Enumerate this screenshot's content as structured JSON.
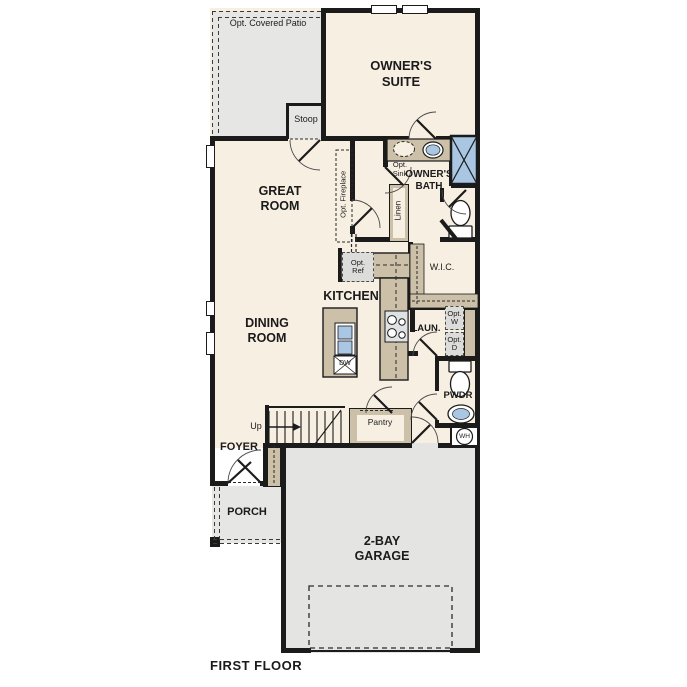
{
  "title": "FIRST FLOOR",
  "colors": {
    "floor_cream": "#f7efe2",
    "exterior_gray": "#e6e6e4",
    "cabinet_tan": "#ccc0a8",
    "water_blue": "#a9c6e3",
    "wall_black": "#1b1b1b",
    "appliance_gray": "#dcdcda"
  },
  "labels": {
    "patio": "Opt. Covered Patio",
    "stoop": "Stoop",
    "owners_suite": "OWNER'S\nSUITE",
    "great_room": "GREAT\nROOM",
    "opt_fireplace": "Opt. Fireplace",
    "opt_sink": "Opt.\nSink",
    "owners_bath": "OWNER'S\nBATH",
    "linen": "Linen",
    "wic": "W.I.C.",
    "opt_ref": "Opt.\nRef",
    "kitchen": "KITCHEN",
    "dining_room": "DINING\nROOM",
    "laundry": "LAUN.",
    "opt_w": "Opt.\nW",
    "opt_d": "Opt.\nD",
    "dw": "DW",
    "pwdr": "PWDR",
    "wh": "WH",
    "up": "Up",
    "pantry": "Pantry",
    "foyer": "FOYER",
    "porch": "PORCH",
    "garage": "2-BAY\nGARAGE"
  }
}
